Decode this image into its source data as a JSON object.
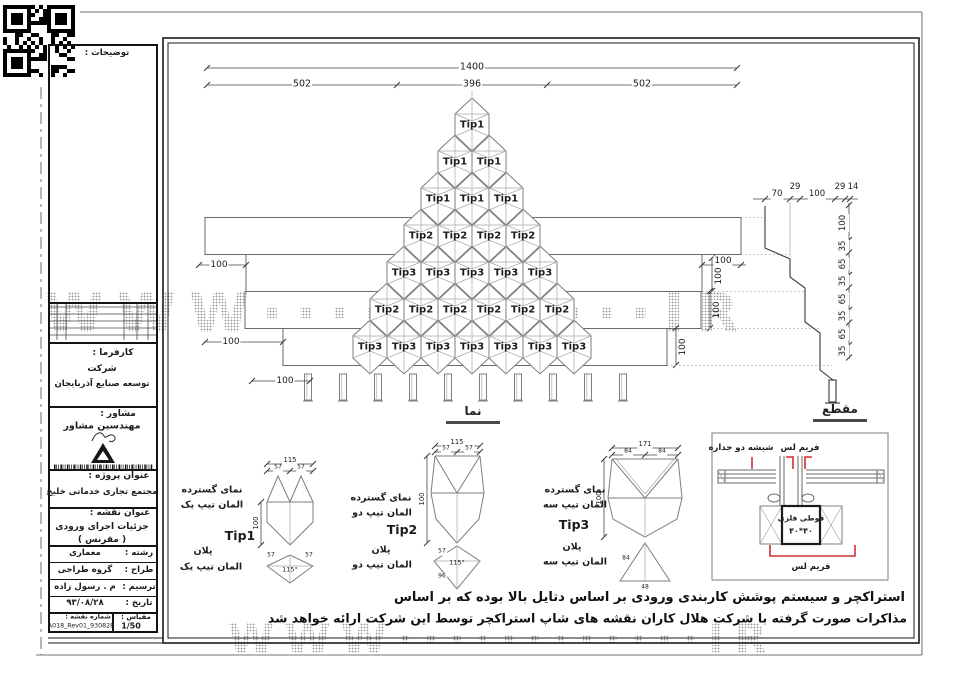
{
  "watermark": {
    "text": "WWW············IR"
  },
  "title_block": {
    "notes_label": "توضیحات :",
    "client": {
      "label": "کارفرما :",
      "line1": "شرکت",
      "line2": "توسعه صنایع آذربایجان"
    },
    "consultant": {
      "label": "مشاور :",
      "line1": "مهندسین مشاور",
      "logo_icon": "a-monogram-logo"
    },
    "project": {
      "label": "عنوان پروژه :",
      "name": "مجتمع تجاری خدماتی خلیج"
    },
    "drawing": {
      "label": "عنوان نقشه :",
      "name": "جزئیات اجرای ورودی",
      "sub": "( مقرنس )"
    },
    "fields": [
      {
        "label": "رشته :",
        "value": "معماری"
      },
      {
        "label": "طراح :",
        "value": "گروه طراحی"
      },
      {
        "label": "ترسیم :",
        "value": "م . رسول زاده"
      },
      {
        "label": "تاریخ :",
        "value": "۹۳/۰۸/۲۸"
      }
    ],
    "sheet_no": {
      "label": "شماره نقشه :",
      "value": "A018_Rev01_930828"
    },
    "scale": {
      "label": "مقیاس :",
      "value": "1/50"
    }
  },
  "elevation": {
    "caption": "نما",
    "total_dim": "1400",
    "part_dims": [
      "502",
      "396",
      "502"
    ],
    "rows": [
      {
        "tip": "Tip1",
        "count": 1
      },
      {
        "tip": "Tip1",
        "count": 2
      },
      {
        "tip": "Tip1",
        "count": 3
      },
      {
        "tip": "Tip2",
        "count": 4
      },
      {
        "tip": "Tip3",
        "count": 5
      },
      {
        "tip": "Tip2",
        "count": 6
      },
      {
        "tip": "Tip3",
        "count": 7
      }
    ],
    "left_dims": [
      "100",
      "100",
      "100"
    ],
    "right_dim_h": "100",
    "right_dims_v": [
      "100",
      "100",
      "100"
    ],
    "hanger_count": 10
  },
  "section": {
    "caption": "مقطع",
    "top_dims": [
      "70",
      "29",
      "100",
      "29",
      "14"
    ],
    "right_dims": [
      "100",
      "35",
      "65",
      "35",
      "65",
      "35",
      "65",
      "35"
    ]
  },
  "details": [
    {
      "id": "Tip1",
      "view_line1": "نمای گسترده",
      "view_line2": "المان تیپ یک",
      "plan_line1": "پلان",
      "plan_line2": "المان تیپ یک",
      "top_dim": "115",
      "sub_dims": [
        "57",
        "57"
      ],
      "height_dim": "100",
      "plan_dims": [
        "57",
        "57"
      ],
      "plan_angle": "115°"
    },
    {
      "id": "Tip2",
      "view_line1": "نمای گسترده",
      "view_line2": "المان تیپ دو",
      "plan_line1": "پلان",
      "plan_line2": "المان تیپ دو",
      "top_dim": "115",
      "sub_dims": [
        "57",
        "57"
      ],
      "height_dim": "100",
      "plan_dims": [
        "57",
        "96"
      ],
      "plan_angle": "115°"
    },
    {
      "id": "Tip3",
      "view_line1": "نمای گسترده",
      "view_line2": "المان تیپ سه",
      "plan_line1": "پلان",
      "plan_line2": "المان تیپ سه",
      "top_dim": "171",
      "sub_dims": [
        "84",
        "84"
      ],
      "height_dim": "100",
      "plan_dims": [
        "84",
        "48"
      ],
      "plan_angle": ""
    }
  ],
  "glazing_detail": {
    "label_glass": "شیشه دو جداره",
    "label_frameless_top": "فریم لس",
    "label_frameless_bottom": "فریم لس",
    "box_line1": "قوطی فلزی",
    "box_line2": "۴۰*۴۰",
    "accent_color": "#d43030"
  },
  "notes": {
    "line1": "استراکچر و سیستم پوشش کاربندی ورودی بر اساس دتایل بالا بوده که بر اساس",
    "line2": "مذاکرات صورت گرفته با شرکت هلال کاران نقشه های شاپ استراکچر توسط این شرکت ارائه خواهد شد"
  }
}
